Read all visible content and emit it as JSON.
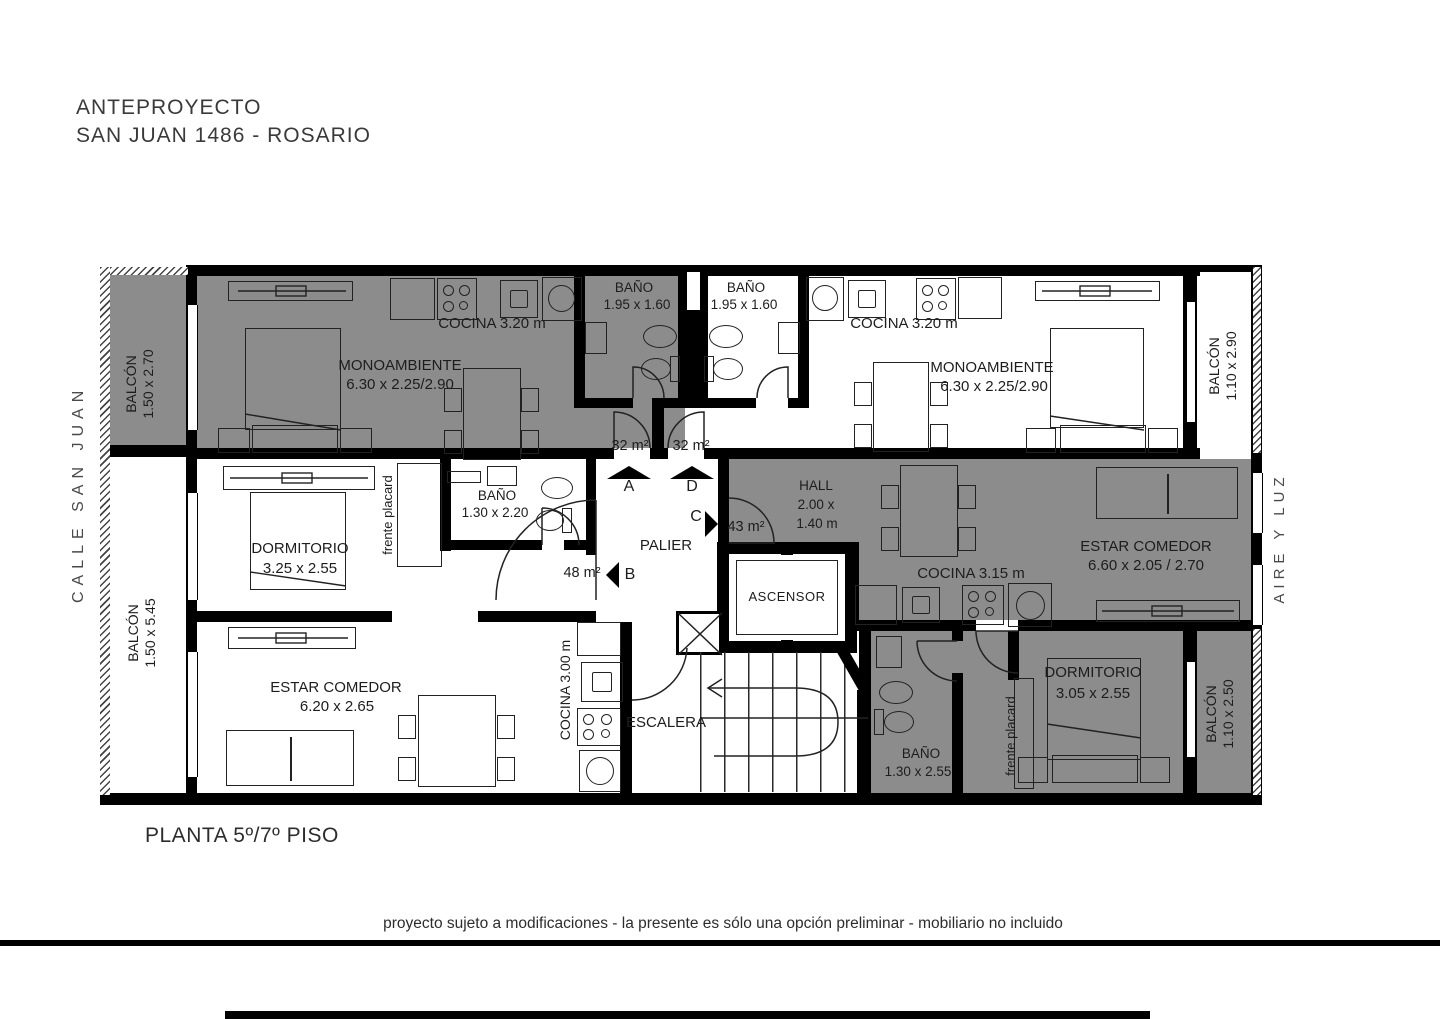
{
  "title": {
    "line1": "ANTEPROYECTO",
    "line2": "SAN JUAN 1486 - ROSARIO"
  },
  "floor_label": "PLANTA 5º/7º PISO",
  "footer": {
    "disclaimer": "proyecto sujeto a modificaciones - la presente es sólo una opción preliminar - mobiliario no incluido"
  },
  "context": {
    "street": "CALLE SAN JUAN",
    "air_light": "AIRE Y LUZ"
  },
  "units": {
    "a": {
      "area": "32 m²",
      "letter": "A"
    },
    "d": {
      "area": "32 m²",
      "letter": "D"
    },
    "c": {
      "area": "43 m²",
      "letter": "C"
    },
    "b": {
      "area": "48 m²",
      "letter": "B"
    }
  },
  "rooms": {
    "monoambiente_left": {
      "name": "MONOAMBIENTE",
      "dims": "6.30 x 2.25/2.90"
    },
    "cocina_top_left": {
      "name": "COCINA 3.20 m"
    },
    "bano_top_left": {
      "name": "BAÑO",
      "dims": "1.95 x 1.60"
    },
    "bano_top_right": {
      "name": "BAÑO",
      "dims": "1.95 x 1.60"
    },
    "cocina_top_right": {
      "name": "COCINA 3.20 m"
    },
    "monoambiente_right": {
      "name": "MONOAMBIENTE",
      "dims": "6.30 x 2.25/2.90"
    },
    "balcon_top_left": {
      "name": "BALCÓN",
      "dims": "1.50 x 2.70"
    },
    "balcon_bottom_left": {
      "name": "BALCÓN",
      "dims": "1.50 x 5.45"
    },
    "balcon_top_right": {
      "name": "BALCÓN",
      "dims": "1.10 x 2.90"
    },
    "balcon_bottom_right": {
      "name": "BALCÓN",
      "dims": "1.10 x 2.50"
    },
    "dormitorio_left": {
      "name": "DORMITORIO",
      "dims": "3.25 x 2.55"
    },
    "bano_mid": {
      "name": "BAÑO",
      "dims": "1.30 x 2.20"
    },
    "placard_mid": {
      "name": "frente placard"
    },
    "hall": {
      "name": "HALL",
      "dims_l1": "2.00 x",
      "dims_l2": "1.40 m"
    },
    "palier": {
      "name": "PALIER"
    },
    "ascensor": {
      "name": "ASCENSOR"
    },
    "escalera": {
      "name": "ESCALERA"
    },
    "estar_comedor_right": {
      "name": "ESTAR COMEDOR",
      "dims": "6.60 x 2.05 / 2.70"
    },
    "cocina_mid_right": {
      "name": "COCINA 3.15 m"
    },
    "estar_comedor_left": {
      "name": "ESTAR COMEDOR",
      "dims": "6.20 x 2.65"
    },
    "cocina_bottom_left": {
      "name": "COCINA 3.00 m"
    },
    "bano_bottom_right": {
      "name": "BAÑO",
      "dims": "1.30 x 2.55"
    },
    "placard_bottom": {
      "name": "frente placard"
    },
    "dormitorio_right": {
      "name": "DORMITORIO",
      "dims": "3.05 x 2.55"
    }
  },
  "colors": {
    "unit_shade": "#8c8c8c",
    "wall": "#000000",
    "background": "#ffffff"
  }
}
